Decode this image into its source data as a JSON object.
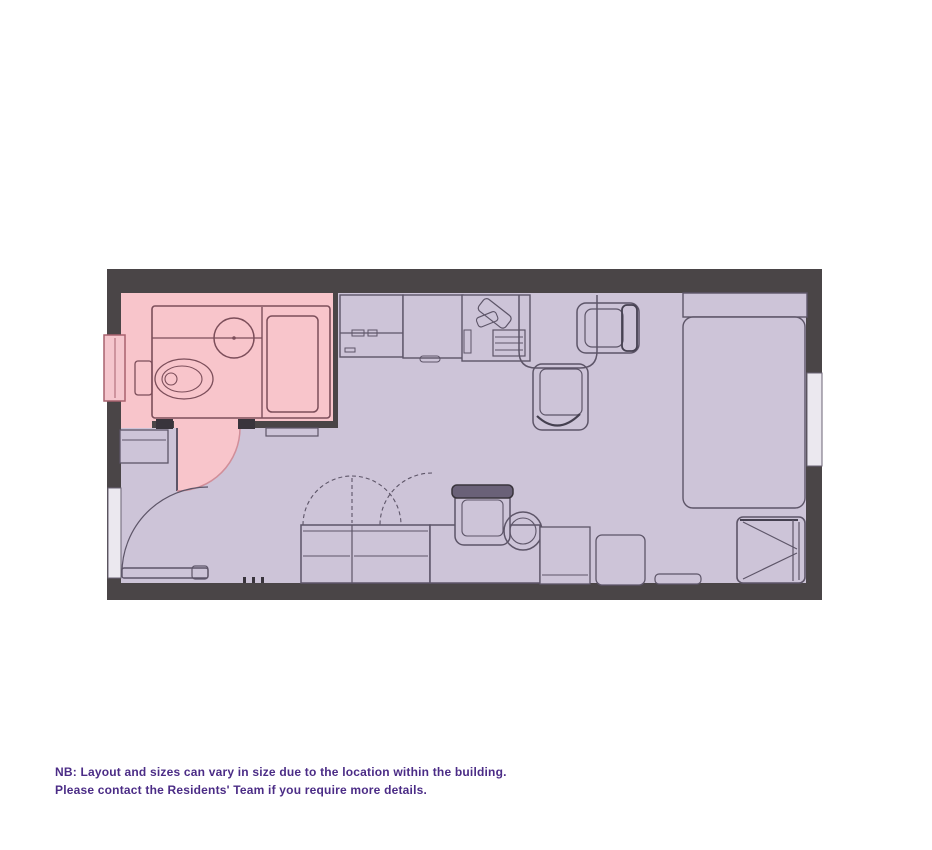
{
  "note": {
    "line1": "NB: Layout and sizes can vary in size due to the location within the building.",
    "line2": "Please contact the Residents' Team if you require more details."
  },
  "colors": {
    "wall": "#4a4547",
    "wall_dark": "#39343c",
    "floor": "#cdc4d8",
    "bathroom": "#f8c5cb",
    "bathroom_fixture": "#7c4e5a",
    "furniture": "#5d5568",
    "furniture_dark": "#454050",
    "window_pink": "#f5c6cd",
    "window_pink_border": "#a8626e",
    "window_light": "#ebe8ef",
    "window_border": "#6b6374",
    "door_arc_pink": "#d18e99",
    "note_text": "#4b2c86",
    "page_bg": "#ffffff"
  },
  "plan": {
    "type": "studio-apartment-floor-plan",
    "highlighted_room": "bathroom",
    "elements": [
      "outer-walls",
      "bathroom",
      "bathroom-window",
      "toilet",
      "sink",
      "vanity",
      "shower",
      "bathroom-door-swing",
      "kitchen-fridge-unit",
      "kitchen-counter",
      "kitchen-hob-unit",
      "table",
      "chair",
      "bed",
      "headboard-shelf",
      "armchair",
      "wardrobe",
      "wardrobe-door-arcs",
      "desk",
      "desk-chair",
      "stool",
      "storage-units",
      "entrance-door",
      "windows"
    ]
  }
}
